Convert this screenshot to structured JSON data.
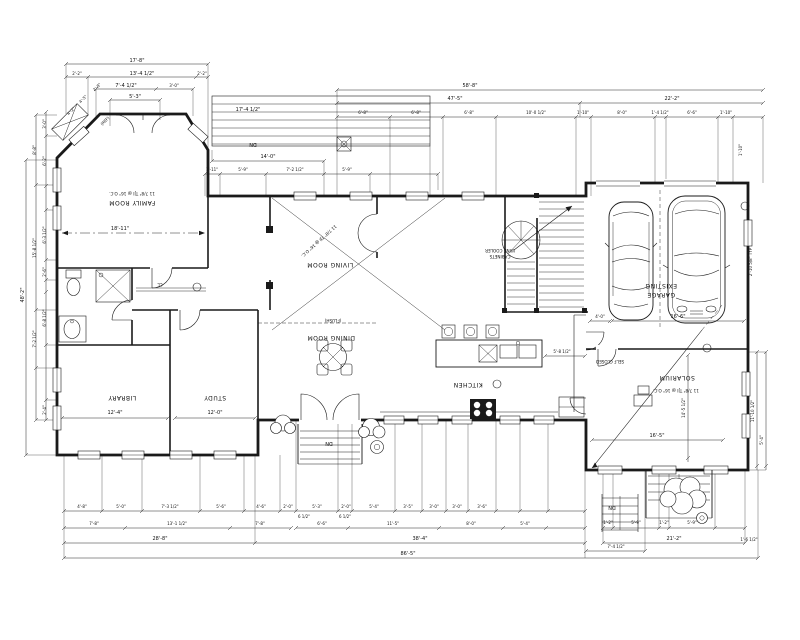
{
  "drawing": {
    "type": "architectural first floor plan",
    "ink": "#1a1a1a",
    "background": "#ffffff",
    "labels": {
      "family": "FAMILY ROOM",
      "living": "LIVING ROOM",
      "dining": "DINING ROOM",
      "kitchen": "KITCHEN",
      "library": "LIBRARY",
      "study": "STUDY",
      "garage_line1": "EXISTING",
      "garage_line2": "GARAGE",
      "solarium": "SOLARIUM",
      "flush": "(FLUSH)",
      "self_closed": "SELF CLOSED",
      "wine_line1": "WINE COOLER",
      "wine_line2": "CABINETS",
      "joist_note": "11 7/8\" TJI @ 16\" O.C.",
      "dn": "DN",
      "cl": "CL",
      "ref": "(REF)"
    },
    "dims": {
      "top_left": [
        "17'-8\"",
        "2'-2\"",
        "13'-4 1/2\"",
        "2'-2\"",
        "7'-4 1/2\"",
        "3'-0\"",
        "5'-3\""
      ],
      "diag": [
        "4'-5\"",
        "4'-2\"",
        "2'-8\""
      ],
      "top_main": [
        "58'-8\"",
        "47'-5\"",
        "22'-2\"",
        "17'-4 1/2\""
      ],
      "top_segs": [
        "6'-8\"",
        "6'-8\"",
        "6'-8\"",
        "10'-0 1/2\"",
        "1'-10\"",
        "8'-0\"",
        "1'-4 1/2\"",
        "6'-6\"",
        "1'-10\""
      ],
      "deck": [
        "14'-0\"",
        "1'-11\"",
        "5'-9\"",
        "7'-2 1/2\"",
        "5'-9\""
      ],
      "left_col": [
        "3'-0\"",
        "6'-2\"",
        "8'-8\"",
        "15'-8 1/2\"",
        "6'-3 1/2\"",
        "2'-6\"",
        "7'-2 1/2\"",
        "6'-8 1/2\"",
        "2'-4\"",
        "48'-2\""
      ],
      "bottom_r1": [
        "4'-8\"",
        "5'-0\"",
        "7'-3 1/2\"",
        "5'-6\"",
        "4'-6\"",
        "2'-0\"",
        "5'-3\"",
        "2'-0\"",
        "5'-4\"",
        "3'-5\"",
        "3'-0\"",
        "3'-0\"",
        "3'-6\"",
        "6 1/2\"",
        "6 1/2\""
      ],
      "bottom_r2": [
        "7'-8\"",
        "13'-1 1/2\"",
        "7'-8\"",
        "6'-6\"",
        "11'-5\"",
        "8'-0\"",
        "5'-4\""
      ],
      "bottom_r3": [
        "28'-8\"",
        "38'-4\""
      ],
      "bottom_total": "86'-5\"",
      "bottom_right": [
        "1'-2\"",
        "5'-9\"",
        "1'-2\"",
        "5'-9\"",
        "21'-2\"",
        "1'-6 1/2\"",
        "7'-4 1/2\"",
        "11'-10 1/2\"",
        "5'-4\""
      ],
      "right_col": [
        "2'-10 5/8\" TYP",
        "1'-10\""
      ],
      "interior": {
        "family": "18'-11\"",
        "library": "12'-4\"",
        "study": "12'-0\"",
        "garage_a": "4'-0\"",
        "garage_b": "16'-6\"",
        "sol_w": "16'-5\"",
        "sol_h": "14'-5 1/2\"",
        "kitchen_a": "5'-8 1/2\""
      }
    }
  }
}
